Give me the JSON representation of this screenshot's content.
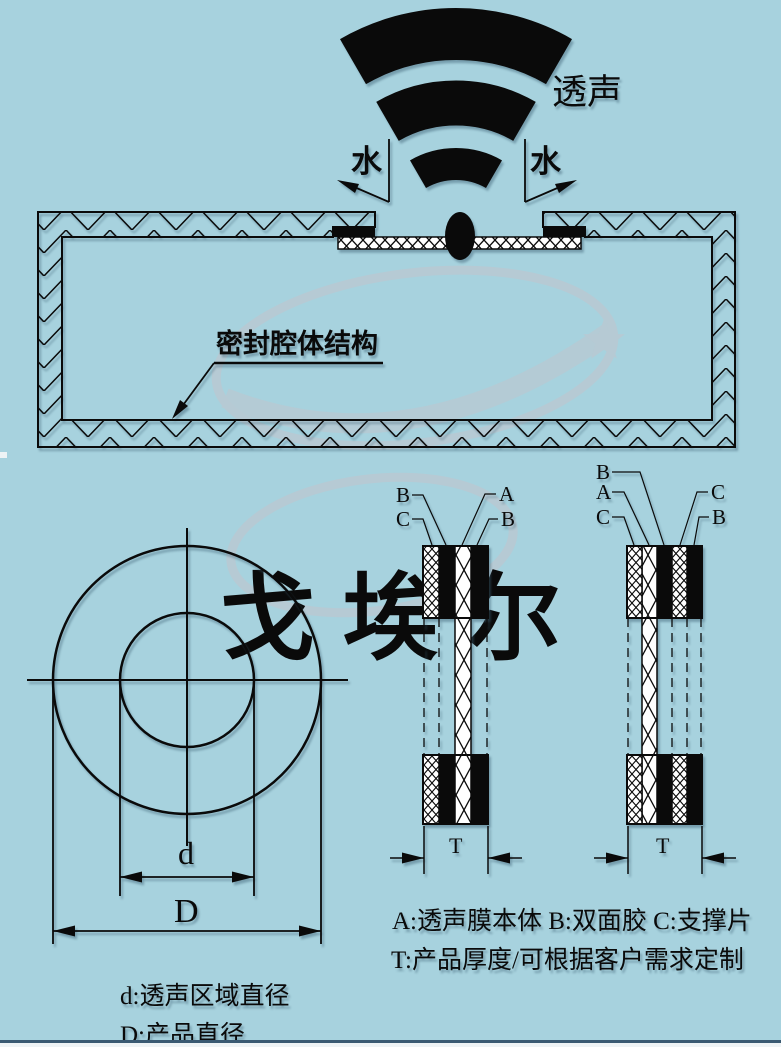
{
  "colors": {
    "background": "#a7d2de",
    "line": "#0a0a0a",
    "watermark": "#b6cad4",
    "bottom_line": "#3a5a72",
    "bottom_strip": "#eef3f5"
  },
  "top": {
    "sound_label": "透声",
    "water_label_left": "水",
    "water_label_right": "水"
  },
  "cavity": {
    "label": "密封腔体结构"
  },
  "circle_diagram": {
    "dim_inner": "d",
    "dim_outer": "D",
    "desc_inner": "d:透声区域直径",
    "desc_outer": "D:产品直径"
  },
  "stack1": {
    "label_top_left": "B",
    "label_bottom_left": "C",
    "label_top_right": "A",
    "label_bottom_right": "B",
    "thickness": "T"
  },
  "stack2": {
    "label_left_1": "B",
    "label_left_2": "A",
    "label_left_3": "C",
    "label_right_1": "C",
    "label_right_2": "B",
    "thickness": "T"
  },
  "legend": {
    "line1": "A:透声膜本体 B:双面胶 C:支撑片",
    "line2": "T:产品厚度/可根据客户需求定制"
  },
  "watermark": {
    "brand_text": "戈 埃 尔"
  }
}
